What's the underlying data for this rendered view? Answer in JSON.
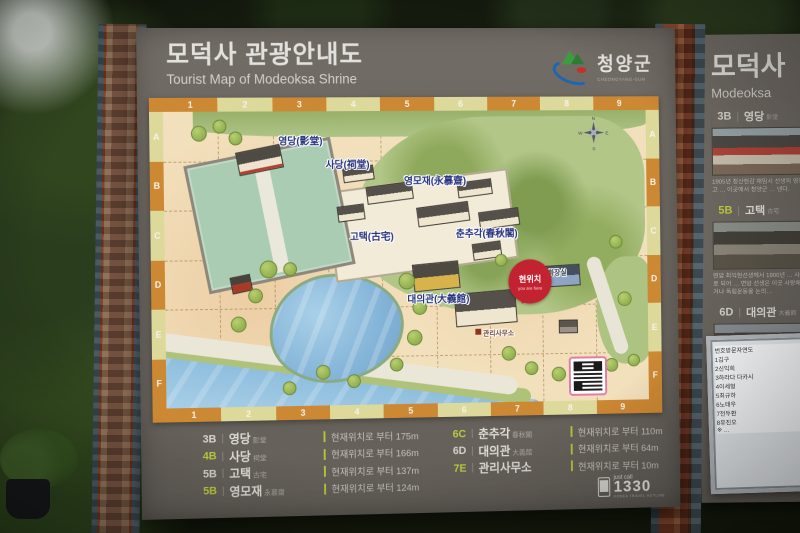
{
  "header": {
    "title_ko": "모덕사 관광안내도",
    "title_en": "Tourist Map of Modeoksa Shrine",
    "logo": {
      "name_ko": "청양군",
      "name_en": "CHEONGYANG-GUN"
    }
  },
  "map": {
    "grid": {
      "cols": [
        "1",
        "2",
        "3",
        "4",
        "5",
        "6",
        "7",
        "8",
        "9"
      ],
      "rows": [
        "A",
        "B",
        "C",
        "D",
        "E",
        "F"
      ]
    },
    "labels": [
      {
        "id": "yeongdang",
        "text": "영당(影堂)"
      },
      {
        "id": "sadang",
        "text": "사당(祠堂)"
      },
      {
        "id": "yeongmojae",
        "text": "영모재(永慕齋)"
      },
      {
        "id": "gotaek",
        "text": "고택(古宅)"
      },
      {
        "id": "chunchugak",
        "text": "춘추각(春秋閣)"
      },
      {
        "id": "daeuigwan",
        "text": "대의관(大義館)"
      },
      {
        "id": "office",
        "text": "관리사무소"
      },
      {
        "id": "restroom",
        "text": "화장실"
      }
    ],
    "you_are_here": {
      "ko": "현위치",
      "en": "you are here"
    },
    "compass": {
      "n": "N",
      "e": "E",
      "s": "S",
      "w": "W"
    }
  },
  "legend": {
    "sep": "|",
    "columns": [
      [
        {
          "code": "3B",
          "code_color": "gray",
          "name": "영당",
          "hanja": "影堂",
          "distance": "현재위치로 부터 175m"
        },
        {
          "code": "4B",
          "code_color": "green",
          "name": "사당",
          "hanja": "祠堂",
          "distance": "현재위치로 부터 166m"
        },
        {
          "code": "5B",
          "code_color": "gray",
          "name": "고택",
          "hanja": "古宅",
          "distance": "현재위치로 부터 137m"
        },
        {
          "code": "5B",
          "code_color": "green",
          "name": "영모재",
          "hanja": "永慕齋",
          "distance": "현재위치로 부터 124m"
        }
      ],
      [
        {
          "code": "6C",
          "code_color": "green",
          "name": "춘추각",
          "hanja": "春秋閣",
          "distance": "현재위치로 부터 110m"
        },
        {
          "code": "6D",
          "code_color": "gray",
          "name": "대의관",
          "hanja": "大義館",
          "distance": "현재위치로 부터 64m"
        },
        {
          "code": "7E",
          "code_color": "green",
          "name": "관리사무소",
          "hanja": "",
          "distance": "현재위치로 부터 10m"
        }
      ]
    ]
  },
  "hotline": {
    "label": "just call",
    "number": "1330",
    "sub": "KOREA TRAVEL HOTLINE"
  },
  "side_panel": {
    "title_ko": "모덕사",
    "title_en": "Modeoksa",
    "sections": [
      {
        "code": "3B",
        "code_color": "gray",
        "name": "영당",
        "hanja": "影堂",
        "desc": "1905년 정산현감 재임시 선생의 영정을 봉안하고 … 이곳에서 청양군 … 낸다."
      },
      {
        "code": "5B",
        "code_color": "green",
        "name": "고택",
        "hanja": "古宅",
        "desc": "면암 최익현선생께서 1900년 … 사랑채 · 영모재로 되어 … 면암 선생은 이곳 사랑채에서 강의하거나 독립운동을 논의…"
      },
      {
        "code": "6D",
        "code_color": "gray",
        "name": "대의관",
        "hanja": "大義館",
        "desc": "면암 선생의 유품과 유물을 전시하기 위해 건립하였으며, 면암 선생께서 … 학회, 필기구 등 총 9종 128점…"
      }
    ],
    "visitor_table": {
      "headers": [
        "번호",
        "방문자",
        "연도"
      ],
      "rows": [
        [
          "1",
          "김구",
          ""
        ],
        [
          "2",
          "신익희",
          ""
        ],
        [
          "3",
          "하라다 다카시",
          ""
        ],
        [
          "4",
          "이세형",
          ""
        ],
        [
          "5",
          "최규하",
          ""
        ],
        [
          "6",
          "노태우",
          ""
        ],
        [
          "7",
          "전두환",
          ""
        ],
        [
          "8",
          "유진오",
          ""
        ]
      ],
      "note": "※ …"
    }
  }
}
